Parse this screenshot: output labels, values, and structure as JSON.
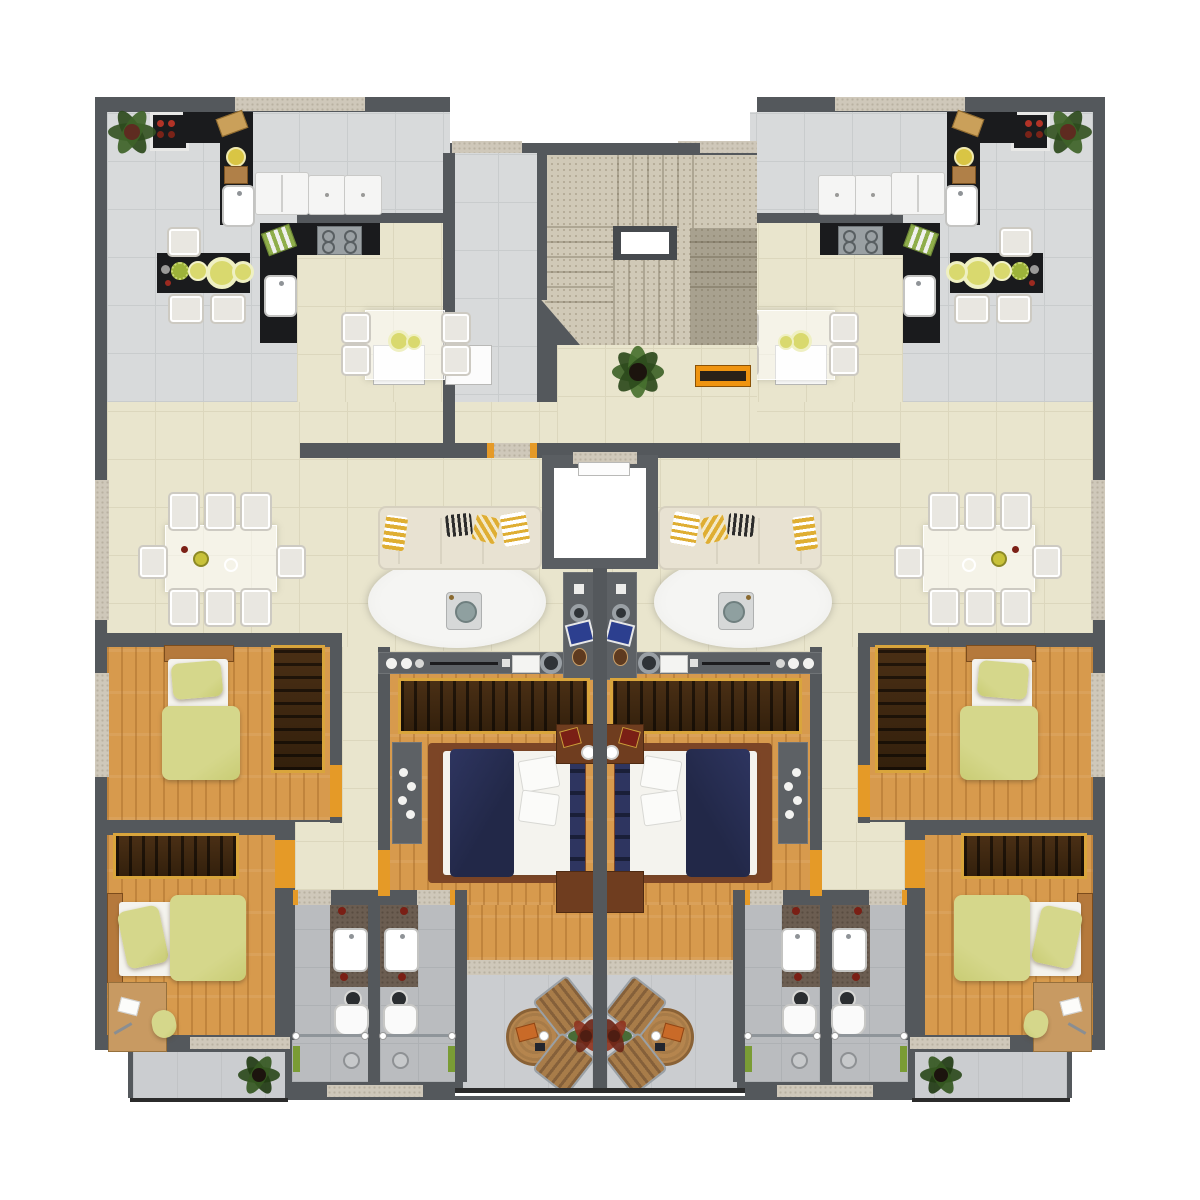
{
  "scene": {
    "type": "architectural-floor-plan",
    "description": "Top-down 3D rendered residential floor plan: two mirrored apartments flanking a central staircase, lobby and elevator; no visible text labels in the image",
    "visible_text": []
  },
  "palette": {
    "wall": "#54585c",
    "tileGray": "#d8dadb",
    "tileLine": "#c9cccd",
    "beige": "#e9e5cd",
    "beigeLine": "#dcd7bd",
    "wood": "#d79a4d",
    "bathTile": "#babcbf",
    "bathLine": "#aeb1b4",
    "balcTile": "#cbcdd0",
    "stair": "#d0c9b7",
    "stairDot": "#b4ab97",
    "counter": "#1a1b1d",
    "white": "#f5f5f4",
    "chair": "#e9e7e1",
    "chairEdge": "#cdcac2",
    "sofa": "#e8e2d2",
    "pillowY": "#dfae33",
    "rug": "#f2f2f0",
    "gold": "#d9a53c",
    "bedFrame": "#7c4526",
    "navy": "#222848",
    "navyLight": "#2e3560",
    "sheet": "#f4f3ee",
    "bedGreen": "#d5d78b",
    "bedGreenDk": "#c9cc74",
    "nightBrown": "#6f3d1f",
    "consoleGray": "#5d6165",
    "knobDark": "#2f3337",
    "chrome": "#9aa0a5",
    "orange": "#e59a27",
    "benchO": "#ef9410",
    "green": "#3b5f27",
    "greenDk": "#27431a",
    "plantRed": "#8f3420",
    "tableWood": "#b5854e",
    "tableWoodEdge": "#8a6236",
    "slat": "#a87c49",
    "slatDk": "#85603a",
    "vanity": "#6b5d51",
    "speckA": "#cfc8ba",
    "speckB": "#b9b1a1",
    "doorWhite": "#fcfcfc",
    "laptopBlue": "#2c3f8f",
    "burnerRed": "#b23327"
  },
  "rooms": [
    {
      "id": "staircase",
      "area": "shared-core"
    },
    {
      "id": "lobby",
      "area": "shared-core"
    },
    {
      "id": "elevator",
      "area": "shared-core"
    },
    {
      "id": "kitchen",
      "area": "each-apartment"
    },
    {
      "id": "dining-nook",
      "area": "each-apartment"
    },
    {
      "id": "entry-corridor",
      "area": "left-apartment"
    },
    {
      "id": "living-dining-room",
      "area": "each-apartment"
    },
    {
      "id": "bedroom-1",
      "area": "each-apartment"
    },
    {
      "id": "bedroom-2",
      "area": "each-apartment"
    },
    {
      "id": "master-bedroom",
      "area": "each-apartment"
    },
    {
      "id": "hallway",
      "area": "each-apartment"
    },
    {
      "id": "bathroom-1",
      "area": "each-apartment"
    },
    {
      "id": "bathroom-2",
      "area": "each-apartment"
    },
    {
      "id": "main-balcony",
      "area": "each-apartment"
    },
    {
      "id": "side-balcony",
      "area": "each-apartment"
    }
  ],
  "furniture": {
    "kitchen": [
      "stove",
      "black-counter",
      "cutting-boards",
      "kitchen-sink",
      "fridge",
      "dishwasher",
      "washer",
      "breakfast-bar",
      "bar-stools",
      "cooktop-hob",
      "fruit-bowls",
      "detergent-bottle",
      "nook-glass-table",
      "nook-chairs"
    ],
    "living": [
      "eight-seat-dining-table",
      "dining-chairs",
      "three-seat-sofa",
      "striped-pillows",
      "oval-rug",
      "coffee-table",
      "tv-console",
      "wall-desk",
      "laptop",
      "vase"
    ],
    "master-bedroom": [
      "double-bed",
      "navy-blanket",
      "pillows",
      "wardrobe",
      "dresser",
      "nightstand",
      "bench"
    ],
    "bedroom": [
      "single-bed",
      "green-blanket",
      "wardrobe",
      "desk",
      "desk-chair",
      "paper"
    ],
    "bathroom": [
      "vanity-counter",
      "sink",
      "toilet",
      "shower-glass",
      "shower-head",
      "towel"
    ],
    "balcony": [
      "round-table",
      "slat-chairs",
      "red-plant",
      "green-plant"
    ],
    "core": [
      "stair-flights",
      "stairwell-void",
      "elevator-cab",
      "lobby-plant",
      "orange-bench"
    ]
  }
}
